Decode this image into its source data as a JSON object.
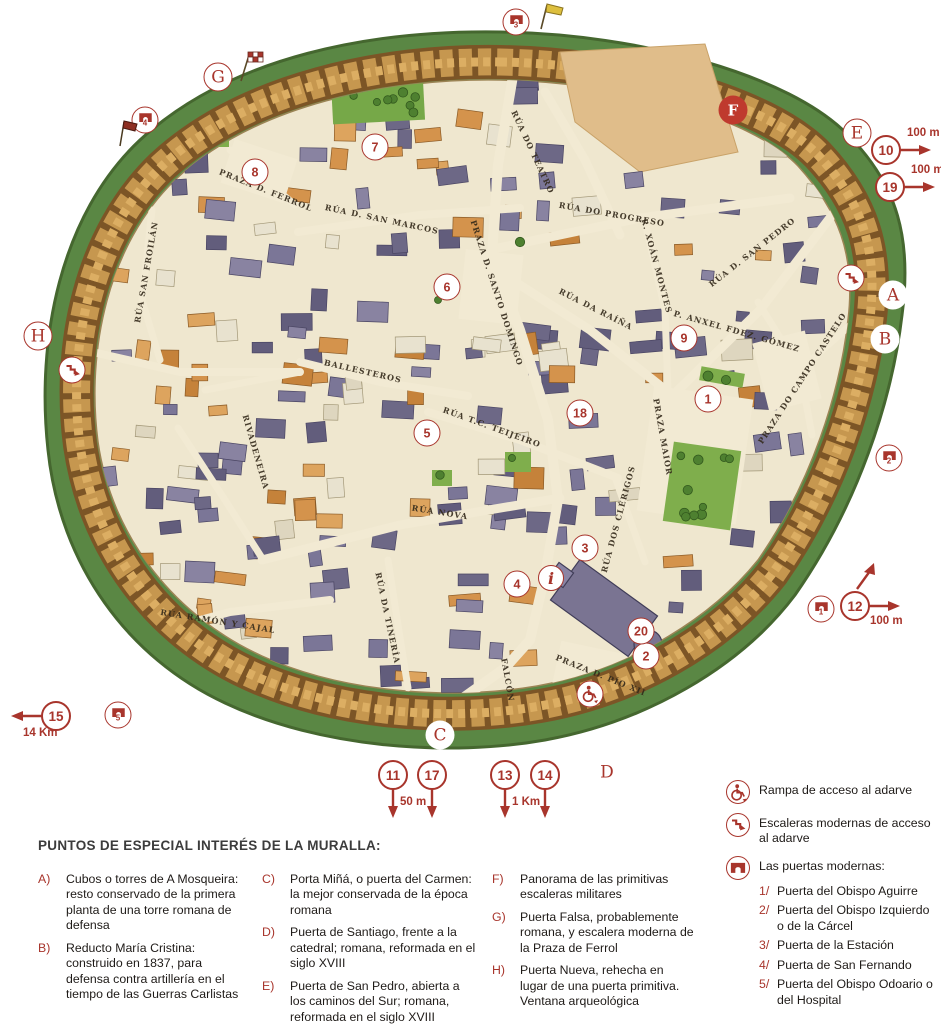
{
  "colors": {
    "accent": "#a8352c",
    "wall": "#c6974f",
    "moat_green": "#5a8744",
    "interior": "#efe7cf"
  },
  "map": {
    "letter_markers": [
      {
        "label": "G",
        "x": 218,
        "y": 77,
        "variant": "ring"
      },
      {
        "label": "E",
        "x": 857,
        "y": 133,
        "variant": "ring"
      },
      {
        "label": "H",
        "x": 38,
        "y": 336,
        "variant": "ring"
      },
      {
        "label": "A",
        "x": 893,
        "y": 295,
        "variant": "plain"
      },
      {
        "label": "B",
        "x": 885,
        "y": 339,
        "variant": "plain"
      },
      {
        "label": "C",
        "x": 440,
        "y": 735,
        "variant": "plain"
      },
      {
        "label": "D",
        "x": 607,
        "y": 772,
        "variant": "plain"
      },
      {
        "label": "F",
        "x": 733,
        "y": 110,
        "variant": "solid"
      }
    ],
    "number_markers": [
      {
        "label": "1",
        "x": 708,
        "y": 399
      },
      {
        "label": "2",
        "x": 646,
        "y": 656
      },
      {
        "label": "3",
        "x": 585,
        "y": 548
      },
      {
        "label": "4",
        "x": 517,
        "y": 584
      },
      {
        "label": "5",
        "x": 427,
        "y": 433
      },
      {
        "label": "6",
        "x": 447,
        "y": 287
      },
      {
        "label": "7",
        "x": 375,
        "y": 147
      },
      {
        "label": "8",
        "x": 255,
        "y": 172
      },
      {
        "label": "9",
        "x": 684,
        "y": 338
      },
      {
        "label": "18",
        "x": 580,
        "y": 413
      },
      {
        "label": "20",
        "x": 641,
        "y": 631
      }
    ],
    "info_marker": {
      "label": "i",
      "x": 551,
      "y": 578
    },
    "edge_markers": [
      {
        "label": "10",
        "x": 886,
        "y": 150,
        "arrow": "right",
        "scale": "100 m"
      },
      {
        "label": "19",
        "x": 890,
        "y": 187,
        "arrow": "right",
        "scale": "100 m"
      },
      {
        "label": "12",
        "x": 855,
        "y": 606,
        "arrow": "right-up",
        "scale": "100 m"
      },
      {
        "label": "15",
        "x": 56,
        "y": 716,
        "arrow": "left",
        "scale": "14 Km"
      },
      {
        "label": "11",
        "x": 393,
        "y": 775,
        "arrow": "down",
        "scale": "50 m"
      },
      {
        "label": "17",
        "x": 432,
        "y": 775,
        "arrow": "down",
        "scale": ""
      },
      {
        "label": "13",
        "x": 505,
        "y": 775,
        "arrow": "down",
        "scale": "1 Km"
      },
      {
        "label": "14",
        "x": 545,
        "y": 775,
        "arrow": "down",
        "scale": ""
      }
    ],
    "gate_markers": [
      {
        "label": "1",
        "x": 821,
        "y": 609
      },
      {
        "label": "2",
        "x": 889,
        "y": 458
      },
      {
        "label": "3",
        "x": 516,
        "y": 22
      },
      {
        "label": "4",
        "x": 145,
        "y": 120
      },
      {
        "label": "5",
        "x": 118,
        "y": 715
      }
    ],
    "stairs_markers": [
      {
        "x": 72,
        "y": 370
      },
      {
        "x": 851,
        "y": 278
      }
    ],
    "wheelchair_markers": [
      {
        "x": 590,
        "y": 694
      }
    ],
    "flags": [
      {
        "type": "checkered",
        "x": 250,
        "y": 66
      },
      {
        "type": "yellow",
        "x": 551,
        "y": 16
      },
      {
        "type": "red",
        "x": 126,
        "y": 133
      }
    ],
    "street_labels": [
      {
        "text": "Rúa do Teatro",
        "x": 533,
        "y": 152,
        "rot": 65
      },
      {
        "text": "Rúa do Progreso",
        "x": 612,
        "y": 214,
        "rot": 10
      },
      {
        "text": "Rúa d. San Marcos",
        "x": 382,
        "y": 219,
        "rot": 12
      },
      {
        "text": "Praza d. Ferrol",
        "x": 266,
        "y": 190,
        "rot": 22
      },
      {
        "text": "Rúa d. San Pedro",
        "x": 752,
        "y": 252,
        "rot": -38
      },
      {
        "text": "Rúa da Raíña",
        "x": 596,
        "y": 309,
        "rot": 27
      },
      {
        "text": "Praza d. Santo Domingo",
        "x": 497,
        "y": 293,
        "rot": 72
      },
      {
        "text": "Ballesteros",
        "x": 363,
        "y": 371,
        "rot": 13
      },
      {
        "text": "Rúa T.C. Teijeiro",
        "x": 492,
        "y": 427,
        "rot": 20
      },
      {
        "text": "Rúa Nova",
        "x": 440,
        "y": 512,
        "rot": 9
      },
      {
        "text": "Praza do Campo Castelo",
        "x": 802,
        "y": 378,
        "rot": -57
      },
      {
        "text": "P. Anxel Fdez. Gómez",
        "x": 737,
        "y": 331,
        "rot": 16
      },
      {
        "text": "Praza Maior",
        "x": 663,
        "y": 437,
        "rot": 80
      },
      {
        "text": "Rúa Ramón y Cajal",
        "x": 218,
        "y": 621,
        "rot": 9
      },
      {
        "text": "Praza d. Pío XII",
        "x": 601,
        "y": 675,
        "rot": 22
      },
      {
        "text": "Rúa San Froilán",
        "x": 146,
        "y": 272,
        "rot": -80
      },
      {
        "text": "Rivadeneira",
        "x": 256,
        "y": 452,
        "rot": 74
      },
      {
        "text": "Rúa dos Clérigos",
        "x": 618,
        "y": 519,
        "rot": -75
      },
      {
        "text": "Falcón",
        "x": 508,
        "y": 680,
        "rot": 80
      },
      {
        "text": "Rúa da Tinería",
        "x": 388,
        "y": 618,
        "rot": 78
      },
      {
        "text": "R. Xoán Montes",
        "x": 657,
        "y": 266,
        "rot": 75
      }
    ]
  },
  "legend": {
    "title": "PUNTOS DE ESPECIAL INTERÉS DE LA MURALLA:",
    "points": [
      {
        "key": "A)",
        "text": "Cubos o torres de A Mosqueira: resto conservado de la primera planta de una torre romana de defensa",
        "col": 0
      },
      {
        "key": "B)",
        "text": "Reducto María Cristina: construido en 1837, para defensa contra artillería en el tiempo de las Guerras Carlistas",
        "col": 0
      },
      {
        "key": "C)",
        "text": "Porta Miñá, o puerta del Carmen: la mejor conservada de la época romana",
        "col": 1
      },
      {
        "key": "D)",
        "text": "Puerta de Santiago, frente a la catedral; romana, reformada en el siglo XVIII",
        "col": 1
      },
      {
        "key": "E)",
        "text": "Puerta de San Pedro, abierta a los caminos del Sur; romana, reformada en el siglo XVIII",
        "col": 1
      },
      {
        "key": "F)",
        "text": "Panorama de las primitivas escaleras militares",
        "col": 2
      },
      {
        "key": "G)",
        "text": "Puerta Falsa, probablemente romana, y escalera moderna de la Praza de Ferrol",
        "col": 2
      },
      {
        "key": "H)",
        "text": "Puerta Nueva, rehecha en lugar de una puerta primitiva. Ventana arqueológica",
        "col": 2
      }
    ],
    "symbols": {
      "ramp_label": "Rampa de acceso al adarve",
      "stairs_label": "Escaleras modernas de acceso al adarve",
      "gates_title": "Las puertas modernas:",
      "modern_gates": [
        {
          "num": "1/",
          "text": "Puerta del Obispo Aguirre"
        },
        {
          "num": "2/",
          "text": "Puerta del Obispo Izquierdo o de la Cárcel"
        },
        {
          "num": "3/",
          "text": "Puerta de la Estación"
        },
        {
          "num": "4/",
          "text": "Puerta de San Fernando"
        },
        {
          "num": "5/",
          "text": "Puerta del Obispo Odoario o del Hospital"
        }
      ]
    }
  }
}
